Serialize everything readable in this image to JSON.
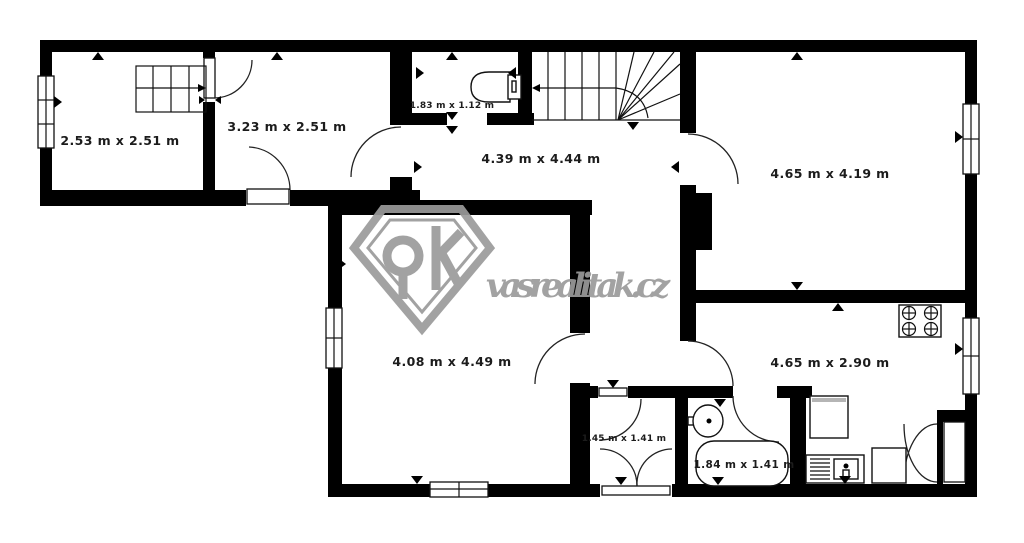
{
  "page": {
    "background": "#ffffff",
    "wall_color": "#000000",
    "label_color": "#1c1c1c"
  },
  "watermark": {
    "site_text": "vasrealitak.cz",
    "color": "#9b9b9b",
    "logo": "diamond-ok-logo"
  },
  "rooms": [
    {
      "id": "room-top-left",
      "label": "2.53 m x 2.51 m"
    },
    {
      "id": "room-top-middle",
      "label": "3.23 m x 2.51 m"
    },
    {
      "id": "toilet",
      "label": "1.83 m x 1.12 m"
    },
    {
      "id": "hall",
      "label": "4.39 m x 4.44 m"
    },
    {
      "id": "room-top-right",
      "label": "4.65 m x 4.19 m"
    },
    {
      "id": "room-bottom-left",
      "label": "4.08 m x 4.49 m"
    },
    {
      "id": "kitchen",
      "label": "4.65 m x 2.90 m"
    },
    {
      "id": "vestibule",
      "label": "1.45 m x 1.41 m"
    },
    {
      "id": "bathroom",
      "label": "1.84 m x 1.41 m"
    }
  ]
}
